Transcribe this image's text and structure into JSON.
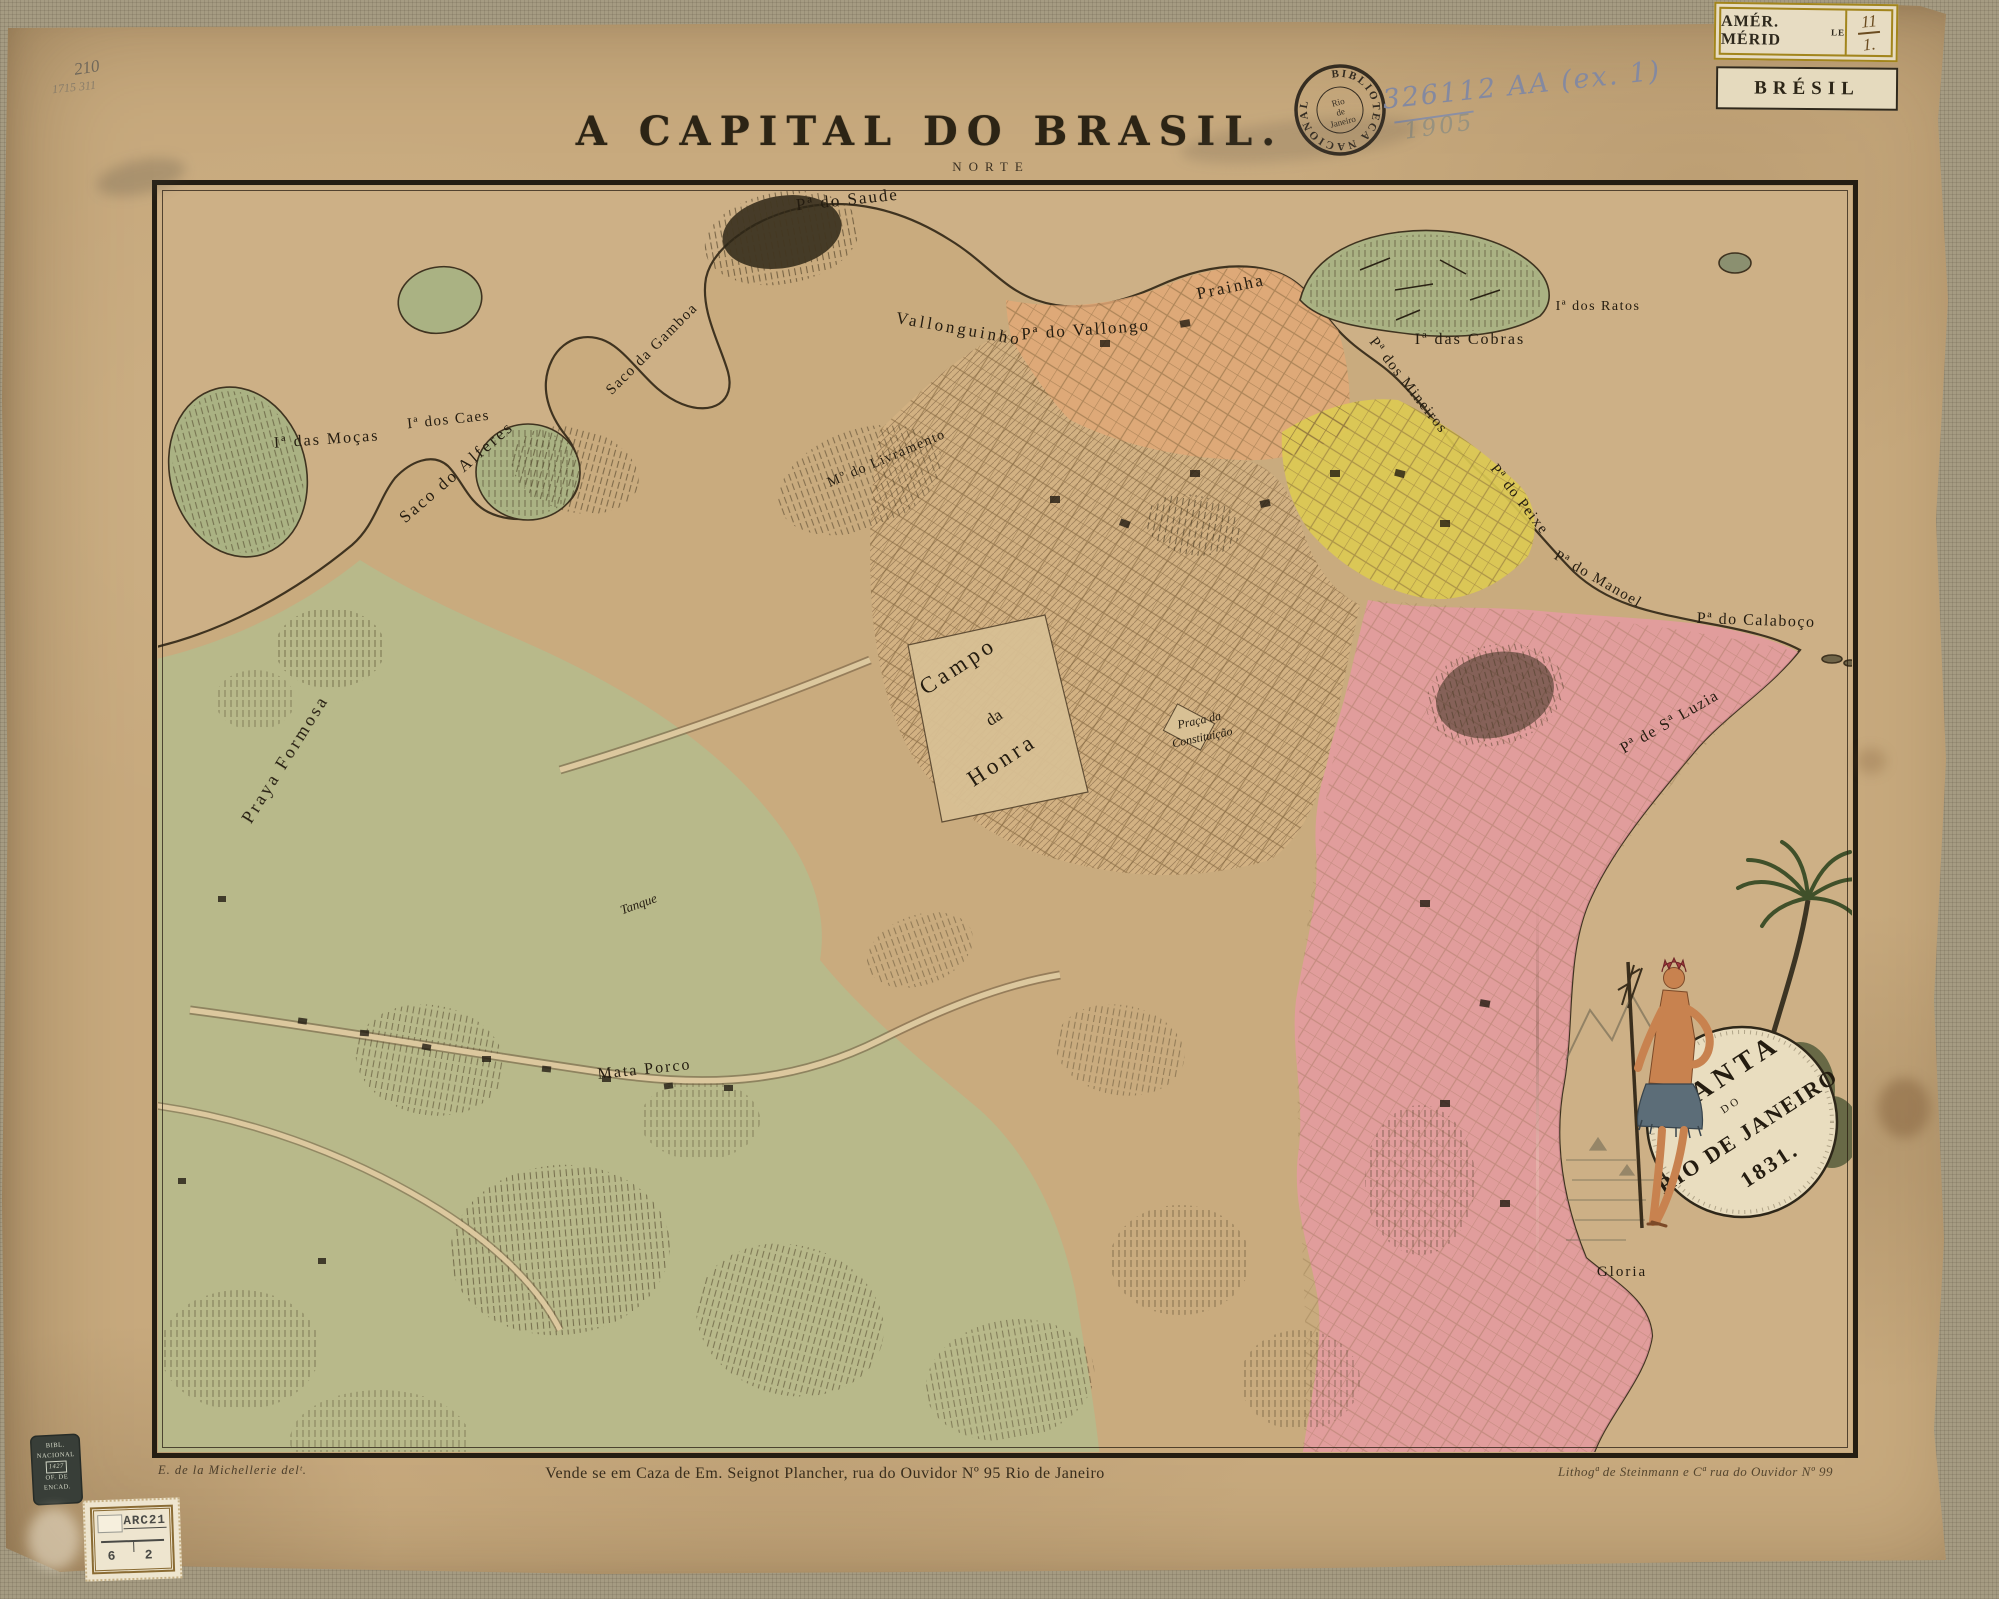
{
  "header": {
    "title": "A CAPITAL DO BRASIL.",
    "north_label": "NORTE"
  },
  "library_marks": {
    "pencil_number_top": "210",
    "pencil_number_small": "1715  311",
    "round_stamp_ring": "BIBLIOTECA NACIONAL",
    "round_stamp_center_1": "Rio",
    "round_stamp_center_2": "de",
    "round_stamp_center_3": "Janeiro",
    "accession_number": "326112 AA (ex. 1)",
    "accession_year": "1905",
    "binder_stamp_line_1": "BIBL.",
    "binder_stamp_line_2": "NACIONAL",
    "binder_stamp_line_3": "1427",
    "binder_stamp_line_4": "OF. DE",
    "binder_stamp_line_5": "ENCAD.",
    "catalog_stamp_code": "ARC21",
    "catalog_stamp_left": "6",
    "catalog_stamp_right": "2"
  },
  "collection_labels": {
    "region": "AMÉR. MÉRID",
    "region_sup": "LE",
    "shelf_top": "11",
    "shelf_bottom": "1.",
    "country": "BRÉSIL"
  },
  "map_labels": {
    "saude": "Pª do Saude",
    "prainha": "Prainha",
    "vallonguinho": "Vallonguinho",
    "vallongo": "Pª do Vallongo",
    "cobras": "Iª das Cobras",
    "ratos": "Iª dos Ratos",
    "gamboa": "Saco da Gamboa",
    "mocas": "Iª das Moças",
    "caes": "Iª dos Caes",
    "alferes": "Saco do Alferes",
    "livramento": "Mº do Livramento",
    "mineiros": "Pª dos Mineiros",
    "peixe": "Pª do Peixe",
    "manoel": "Pª do Manoel",
    "calaboco": "Pª do Calaboço",
    "luzia": "Pª de Sª Luzia",
    "formosa": "Praya Formosa",
    "campo_1": "Campo",
    "campo_2": "da",
    "campo_3": "Honra",
    "praca_1": "Praça da",
    "praca_2": "Constituição",
    "mata_porco": "Mata Porco",
    "tanque": "Tanque",
    "gloria": "Gloria"
  },
  "cartouche": {
    "line_1": "PLANTA",
    "line_2": "DO",
    "line_3": "RIO DE JANEIRO",
    "line_4": "1831."
  },
  "imprints": {
    "delineator": "E. de la Michellerie delᵗ.",
    "publisher": "Vende se em Caza de Em. Seignot Plancher, rua do Ouvidor Nº 95 Rio de Janeiro",
    "lithographer": "Lithogª de Steinmann e Cª rua do Ouvidor Nº 99"
  },
  "legend_colors": {
    "paper": "#c8aa7e",
    "rural_green": "#b6ba8b",
    "waterfront_salmon": "#e2a877",
    "city_yellow": "#ddca52",
    "south_pink": "#e59aa1",
    "ink": "#2b2318"
  }
}
